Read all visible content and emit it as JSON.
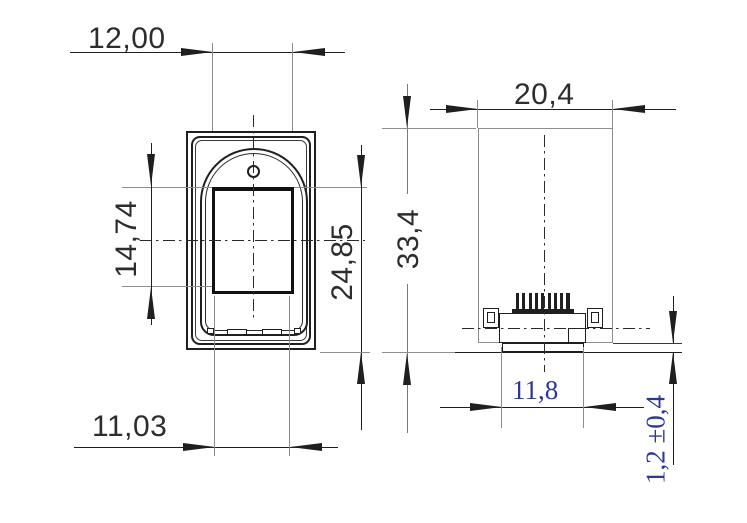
{
  "drawing": {
    "component": "fingerprint-reader-module-dimension-drawing",
    "background": "#ffffff",
    "line_colors": {
      "primary": "#1f1f1f",
      "secondary": "#8d8d8d",
      "centerline": "#2b2b2b"
    },
    "dim_text_color": "#2d2d2d",
    "dim_text_color_alt": "#2e3799",
    "front_view": {
      "label": "front-view",
      "dims": {
        "top_width": "12,00",
        "left_height": "14,74",
        "right_height": "24,85",
        "bottom_width": "11,03"
      }
    },
    "side_view": {
      "label": "side-view",
      "connector_pin_count": 9,
      "dims": {
        "top_width": "20,4",
        "left_height": "33,4",
        "connector_width": "11,8",
        "standoff_height": "1,2 ±0,4"
      }
    }
  }
}
